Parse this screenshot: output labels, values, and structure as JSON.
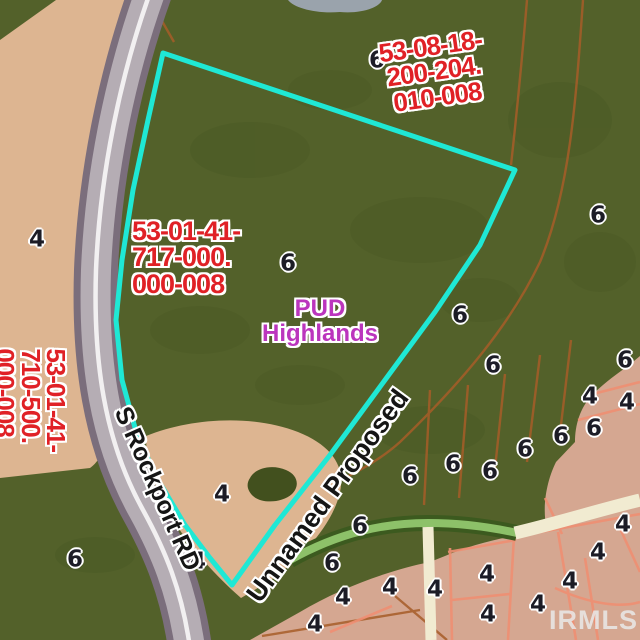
{
  "watermark": "IRMLS",
  "parcel_ids": {
    "northeast": {
      "lines": [
        "53-08-18-",
        "200-204.",
        "010-008"
      ]
    },
    "center": {
      "lines": [
        "53-01-41-",
        "717-000.",
        "000-008"
      ]
    },
    "southwest": {
      "lines": [
        "53-01-41-",
        "710-500.",
        "000-008"
      ]
    }
  },
  "zoning_label": {
    "line1": "PUD",
    "line2": "Highlands"
  },
  "road_labels": {
    "rockport": "S Rockport RD",
    "unnamed": "Unnamed Proposed"
  },
  "zone_numbers": [
    {
      "t": "6",
      "x": 377,
      "y": 61
    },
    {
      "t": "6",
      "x": 598,
      "y": 216
    },
    {
      "t": "6",
      "x": 288,
      "y": 264
    },
    {
      "t": "6",
      "x": 460,
      "y": 316
    },
    {
      "t": "6",
      "x": 493,
      "y": 366
    },
    {
      "t": "6",
      "x": 625,
      "y": 361
    },
    {
      "t": "6",
      "x": 561,
      "y": 437
    },
    {
      "t": "6",
      "x": 594,
      "y": 429
    },
    {
      "t": "6",
      "x": 525,
      "y": 450
    },
    {
      "t": "6",
      "x": 490,
      "y": 472
    },
    {
      "t": "6",
      "x": 453,
      "y": 465
    },
    {
      "t": "6",
      "x": 410,
      "y": 477
    },
    {
      "t": "6",
      "x": 360,
      "y": 527
    },
    {
      "t": "6",
      "x": 332,
      "y": 564
    },
    {
      "t": "6",
      "x": 75,
      "y": 560
    },
    {
      "t": "4",
      "x": 37,
      "y": 240
    },
    {
      "t": "4",
      "x": 222,
      "y": 495
    },
    {
      "t": "4",
      "x": 198,
      "y": 562
    },
    {
      "t": "4",
      "x": 590,
      "y": 397
    },
    {
      "t": "4",
      "x": 627,
      "y": 403
    },
    {
      "t": "4",
      "x": 623,
      "y": 525
    },
    {
      "t": "4",
      "x": 598,
      "y": 553
    },
    {
      "t": "4",
      "x": 570,
      "y": 582
    },
    {
      "t": "4",
      "x": 487,
      "y": 575
    },
    {
      "t": "4",
      "x": 488,
      "y": 615
    },
    {
      "t": "4",
      "x": 538,
      "y": 605
    },
    {
      "t": "4",
      "x": 435,
      "y": 590
    },
    {
      "t": "4",
      "x": 343,
      "y": 598
    },
    {
      "t": "4",
      "x": 315,
      "y": 625
    },
    {
      "t": "4",
      "x": 390,
      "y": 588
    }
  ],
  "colors": {
    "green_dark": "#53612a",
    "green_shadow": "#42501e",
    "tan": "#ddb591",
    "tan_pink": "#d5a791",
    "road_shoulder": "#7b6e7c",
    "road_surface": "#b5adb4",
    "road_line": "#f2f0f1",
    "boundary_cyan": "#1fe8d5",
    "parcel_line_orange": "#a75d28",
    "parcel_line_salmon": "#ef8f73",
    "road_green_dark": "#3c5a1f",
    "road_green_light": "#8dc169",
    "road_cream": "#f1ebd1",
    "water_grey": "#9aa3ac",
    "label_red": "#e02126",
    "label_purple": "#bb35bd",
    "label_black": "#1c1c26",
    "watermark": "#e9e9e9"
  }
}
